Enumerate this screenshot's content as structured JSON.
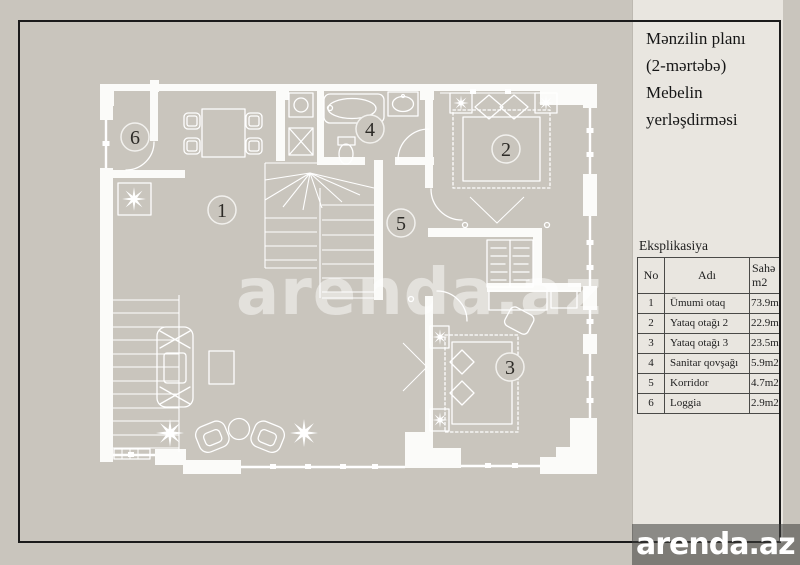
{
  "panel": {
    "title": "Mənzilin planı\n(2-mərtəbə)\nMebelin\nyerləşdirməsi",
    "table": {
      "caption": "Eksplikasiya",
      "headers": {
        "no": "No",
        "name": "Adı",
        "area": "Sahə\nm2"
      },
      "rows": [
        {
          "no": "1",
          "name": "Ümumi otaq",
          "area": "73.9m2"
        },
        {
          "no": "2",
          "name": "Yataq otağı 2",
          "area": "22.9m2"
        },
        {
          "no": "3",
          "name": "Yataq otağı 3",
          "area": "23.5m2"
        },
        {
          "no": "4",
          "name": "Sanitar qovşağı",
          "area": "5.9m2"
        },
        {
          "no": "5",
          "name": "Korridor",
          "area": "4.7m2"
        },
        {
          "no": "6",
          "name": "Loggia",
          "area": "2.9m2"
        }
      ]
    }
  },
  "plan": {
    "rooms": [
      {
        "number": "1"
      },
      {
        "number": "2"
      },
      {
        "number": "3"
      },
      {
        "number": "4"
      },
      {
        "number": "5"
      },
      {
        "number": "6"
      }
    ]
  },
  "watermark": {
    "center_text": "arenda.az"
  },
  "footer": {
    "logo_text": "arenda.az"
  },
  "colors": {
    "background": "#c9c5bd",
    "panel": "#e9e6e0",
    "frame": "#1b1b1b",
    "plan_lines": "#ffffff"
  }
}
